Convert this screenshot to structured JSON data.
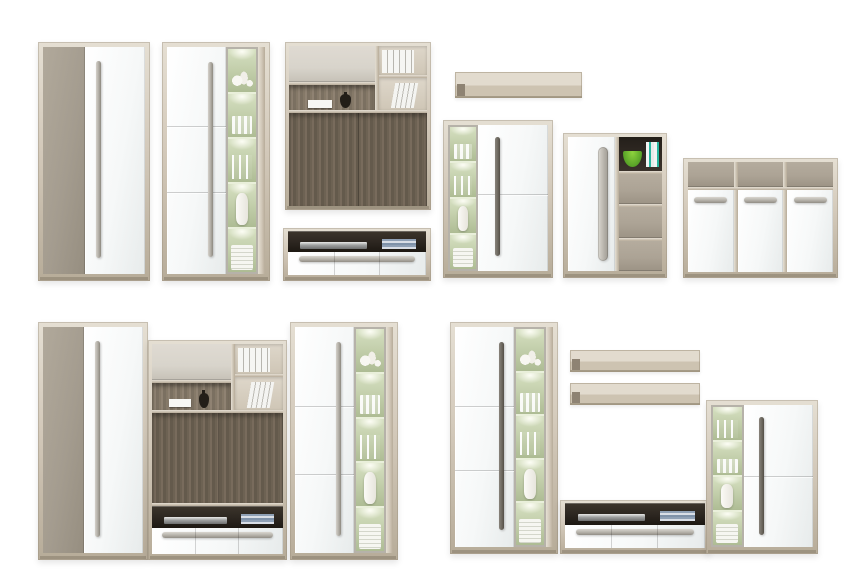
{
  "scene": {
    "title": "Living room furniture collection — product collage on white background",
    "background": "#ffffff",
    "groups": [
      {
        "name": "top-row-individual-pieces",
        "items": [
          "wardrobe",
          "display-cabinet-glass-right",
          "wall-storage-unit",
          "tv-lowboard",
          "wall-shelf",
          "display-cabinet-glass-left",
          "highboard",
          "sideboard"
        ]
      },
      {
        "name": "bottom-left-wall-set",
        "items": [
          "wardrobe",
          "media-wall-unit-with-lowboard",
          "display-cabinet-glass-right"
        ]
      },
      {
        "name": "bottom-right-wall-set",
        "items": [
          "display-cabinet-glass-right",
          "wall-shelf",
          "wall-shelf",
          "tv-lowboard",
          "display-cabinet-glass-left"
        ]
      }
    ]
  },
  "palette": {
    "bg": "#ffffff",
    "ash_wood": "#d3c9ba",
    "ash_wood_light": "#e5dfd3",
    "ash_wood_dark": "#b7ac99",
    "taupe": "#a49c8f",
    "taupe_drawer": "#aca395",
    "greige_flap": "#d8d4cb",
    "white_front": "#f6f8f8",
    "dark_oak": "#6d6253",
    "interior_dark": "#2c2620",
    "glass_green": "#bcc9a4",
    "glass_glow": "#eef3da",
    "handle_silver": "#b1ada5",
    "handle_dark": "#6f6a61",
    "accent_green_bowl": "#55a026",
    "book_blue": "#8fa0b5",
    "vase_dark": "#231e18"
  },
  "pieces": [
    {
      "id": "wardrobe-1",
      "label": "Two-door wardrobe — taupe and white gloss fronts, long silver handle"
    },
    {
      "id": "display-cabinet-1",
      "label": "Tall display cabinet — white door left, LED-lit glass showcase right"
    },
    {
      "id": "wall-unit-1",
      "label": "Wall storage unit — greige flap, open shelves with binders, dark oak back panel"
    },
    {
      "id": "tv-lowboard-1",
      "label": "TV lowboard — open media shelf with DVD player, white drawers, long handle"
    },
    {
      "id": "wall-shelf-1",
      "label": "Floating wall shelf — light ash"
    },
    {
      "id": "display-cabinet-2",
      "label": "Display cabinet — LED-lit glass showcase left, white door right"
    },
    {
      "id": "highboard-1",
      "label": "Highboard — white door, open niche with green bowl, three taupe drawers"
    },
    {
      "id": "sideboard-1",
      "label": "Sideboard — three taupe drawers over three white doors with handles"
    },
    {
      "id": "wardrobe-2",
      "label": "Two-door wardrobe — taupe and white gloss fronts, long silver handle"
    },
    {
      "id": "media-wall-unit-2",
      "label": "Media wall unit — flap, shelves, dark oak TV panel and lowboard base"
    },
    {
      "id": "display-cabinet-3",
      "label": "Tall display cabinet — white door left, LED-lit glass showcase right"
    },
    {
      "id": "display-cabinet-4",
      "label": "Tall display cabinet — white door left, LED-lit glass showcase right"
    },
    {
      "id": "wall-shelf-2",
      "label": "Floating wall shelf — light ash"
    },
    {
      "id": "wall-shelf-3",
      "label": "Floating wall shelf — light ash"
    },
    {
      "id": "tv-lowboard-2",
      "label": "TV lowboard — open media shelf with DVD player, white drawers, long handle"
    },
    {
      "id": "display-cabinet-5",
      "label": "Display cabinet — LED-lit glass showcase left, white door right"
    }
  ]
}
